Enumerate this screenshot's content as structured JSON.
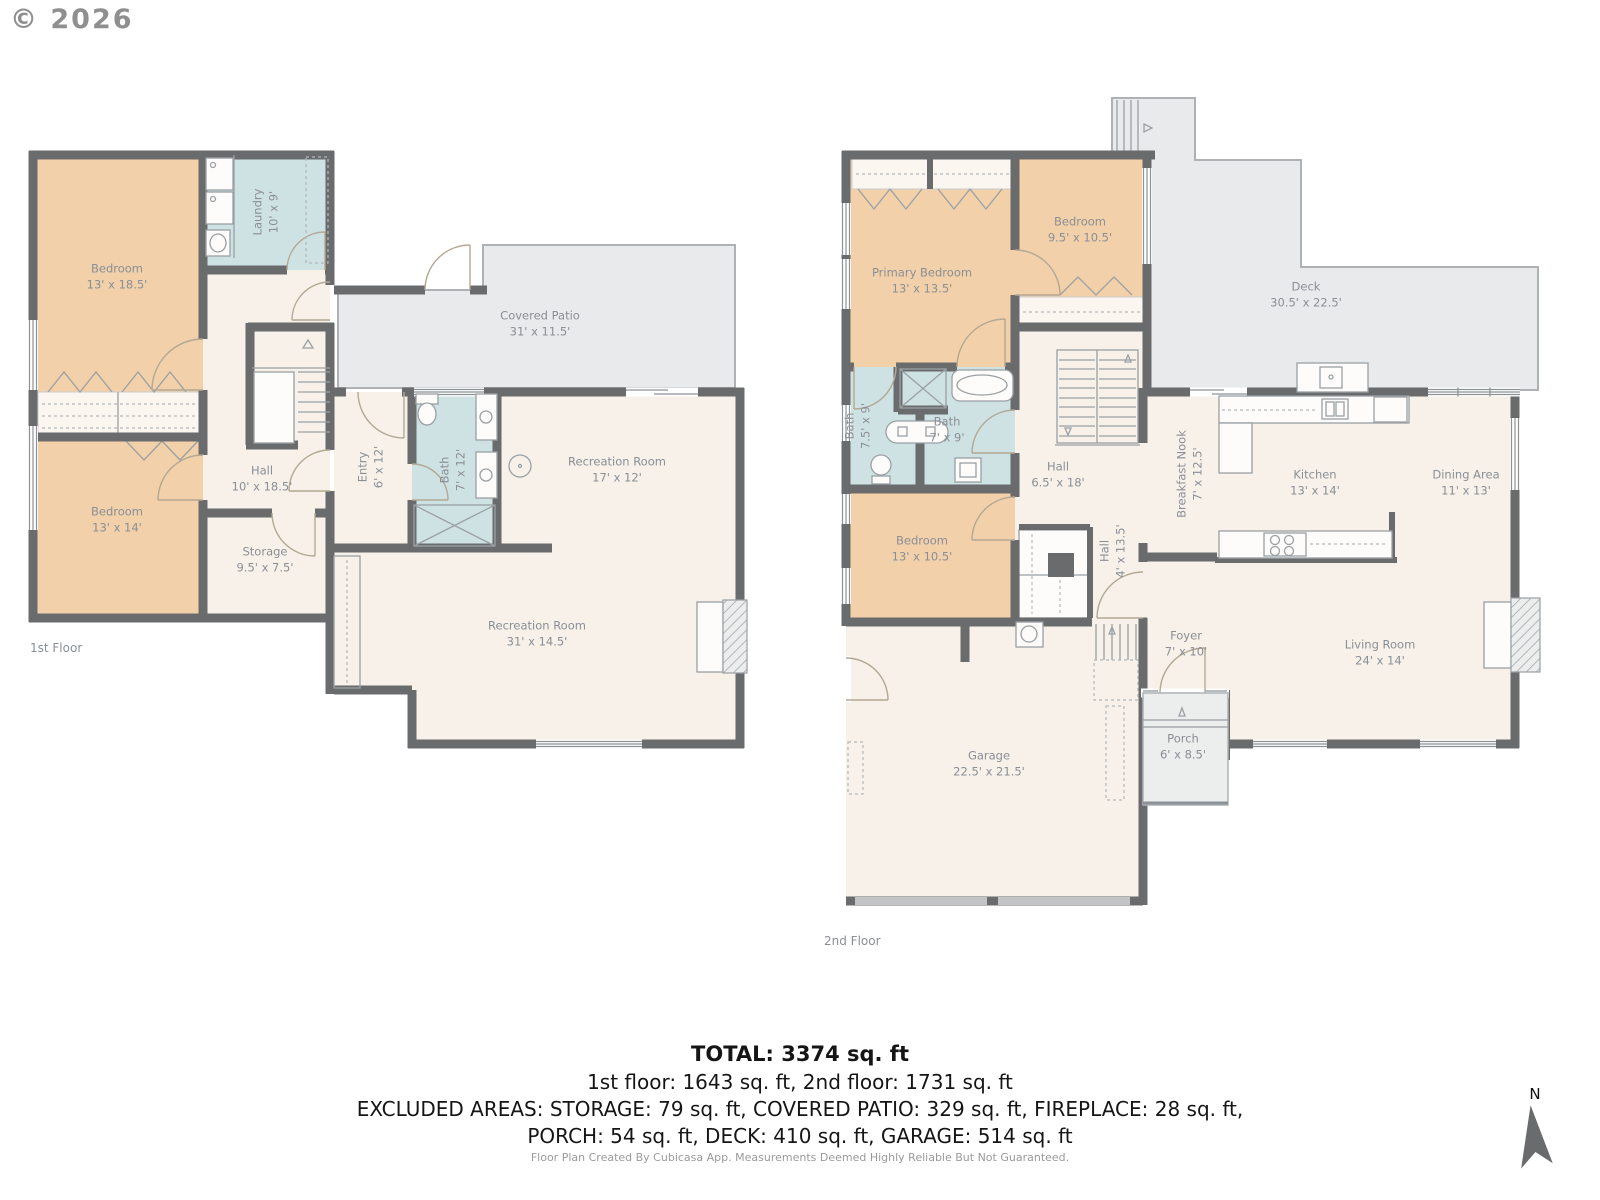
{
  "copyright": "© 2026",
  "compass": {
    "label": "N"
  },
  "floors": [
    {
      "caption": "1st Floor",
      "rooms": [
        {
          "name": "Bedroom",
          "dims": "13' x 18.5'"
        },
        {
          "name": "Laundry",
          "dims": "10' x 9'"
        },
        {
          "name": "Covered Patio",
          "dims": "31' x 11.5'"
        },
        {
          "name": "Hall",
          "dims": "10' x 18.5'"
        },
        {
          "name": "Entry",
          "dims": "6' x 12'"
        },
        {
          "name": "Bath",
          "dims": "7' x 12'"
        },
        {
          "name": "Recreation Room",
          "dims": "17' x 12'"
        },
        {
          "name": "Bedroom",
          "dims": "13' x 14'"
        },
        {
          "name": "Storage",
          "dims": "9.5' x 7.5'"
        },
        {
          "name": "Recreation Room",
          "dims": "31' x 14.5'"
        }
      ]
    },
    {
      "caption": "2nd Floor",
      "rooms": [
        {
          "name": "Primary Bedroom",
          "dims": "13' x 13.5'"
        },
        {
          "name": "Bedroom",
          "dims": "9.5' x 10.5'"
        },
        {
          "name": "Deck",
          "dims": "30.5' x 22.5'"
        },
        {
          "name": "Bath",
          "dims": "7.5' x 9'"
        },
        {
          "name": "Bath",
          "dims": "7' x 9'"
        },
        {
          "name": "Hall",
          "dims": "6.5' x 18'"
        },
        {
          "name": "Breakfast Nook",
          "dims": "7' x 12.5'"
        },
        {
          "name": "Kitchen",
          "dims": "13' x 14'"
        },
        {
          "name": "Dining Area",
          "dims": "11' x 13'"
        },
        {
          "name": "Bedroom",
          "dims": "13' x 10.5'"
        },
        {
          "name": "Hall",
          "dims": "4' x 13.5'"
        },
        {
          "name": "Foyer",
          "dims": "7' x 10'"
        },
        {
          "name": "Living Room",
          "dims": "24' x 14'"
        },
        {
          "name": "Garage",
          "dims": "22.5' x 21.5'"
        },
        {
          "name": "Porch",
          "dims": "6' x 8.5'"
        }
      ]
    }
  ],
  "summary": {
    "total": "TOTAL: 3374 sq. ft",
    "floors_line": "1st floor: 1643 sq. ft, 2nd floor: 1731 sq. ft",
    "excluded_line1": "EXCLUDED AREAS: STORAGE: 79 sq. ft, COVERED PATIO: 329 sq. ft, FIREPLACE: 28 sq. ft,",
    "excluded_line2": "PORCH: 54 sq. ft, DECK: 410 sq. ft, GARAGE: 514 sq. ft",
    "disclaimer": "Floor Plan Created By Cubicasa App. Measurements Deemed Highly Reliable But Not Guaranteed."
  },
  "colors": {
    "wall": "#6a6b6c",
    "bedroom": "#f2d0a9",
    "wet": "#cfe2e3",
    "floor": "#f7f1e9",
    "outdoor": "#e9eaeb",
    "label": "#8a8f96"
  }
}
